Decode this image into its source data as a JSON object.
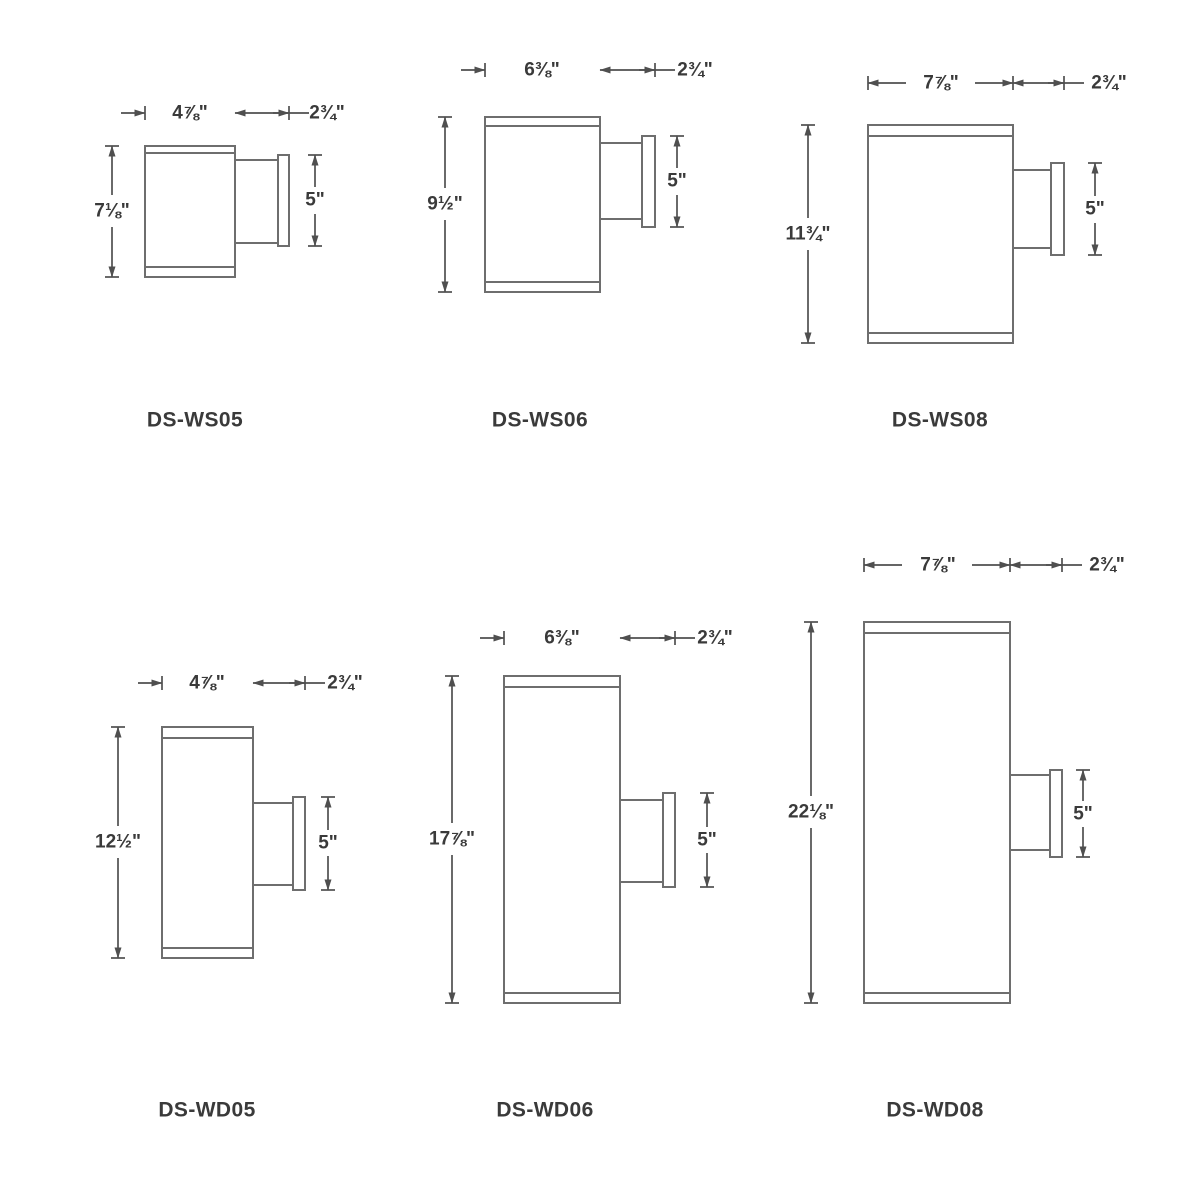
{
  "page": {
    "background_color": "#ffffff",
    "line_color": "#6e6e6e",
    "dimension_color": "#4f4f4f",
    "text_color": "#3a3a3a",
    "units": "inches"
  },
  "drawings": [
    {
      "model": "DS-WS05",
      "style": "single-cylinder",
      "width": "4⅞\"",
      "projection": "2¾\"",
      "height": "7⅛\"",
      "backplate": "5\""
    },
    {
      "model": "DS-WS06",
      "style": "single-cylinder",
      "width": "6⅜\"",
      "projection": "2¾\"",
      "height": "9½\"",
      "backplate": "5\""
    },
    {
      "model": "DS-WS08",
      "style": "single-cylinder",
      "width": "7⅞\"",
      "projection": "2¾\"",
      "height": "11¾\"",
      "backplate": "5\""
    },
    {
      "model": "DS-WD05",
      "style": "double-cylinder",
      "width": "4⅞\"",
      "projection": "2¾\"",
      "height": "12½\"",
      "backplate": "5\""
    },
    {
      "model": "DS-WD06",
      "style": "double-cylinder",
      "width": "6⅜\"",
      "projection": "2¾\"",
      "height": "17⅞\"",
      "backplate": "5\""
    },
    {
      "model": "DS-WD08",
      "style": "double-cylinder",
      "width": "7⅞\"",
      "projection": "2¾\"",
      "height": "22⅛\"",
      "backplate": "5\""
    }
  ]
}
